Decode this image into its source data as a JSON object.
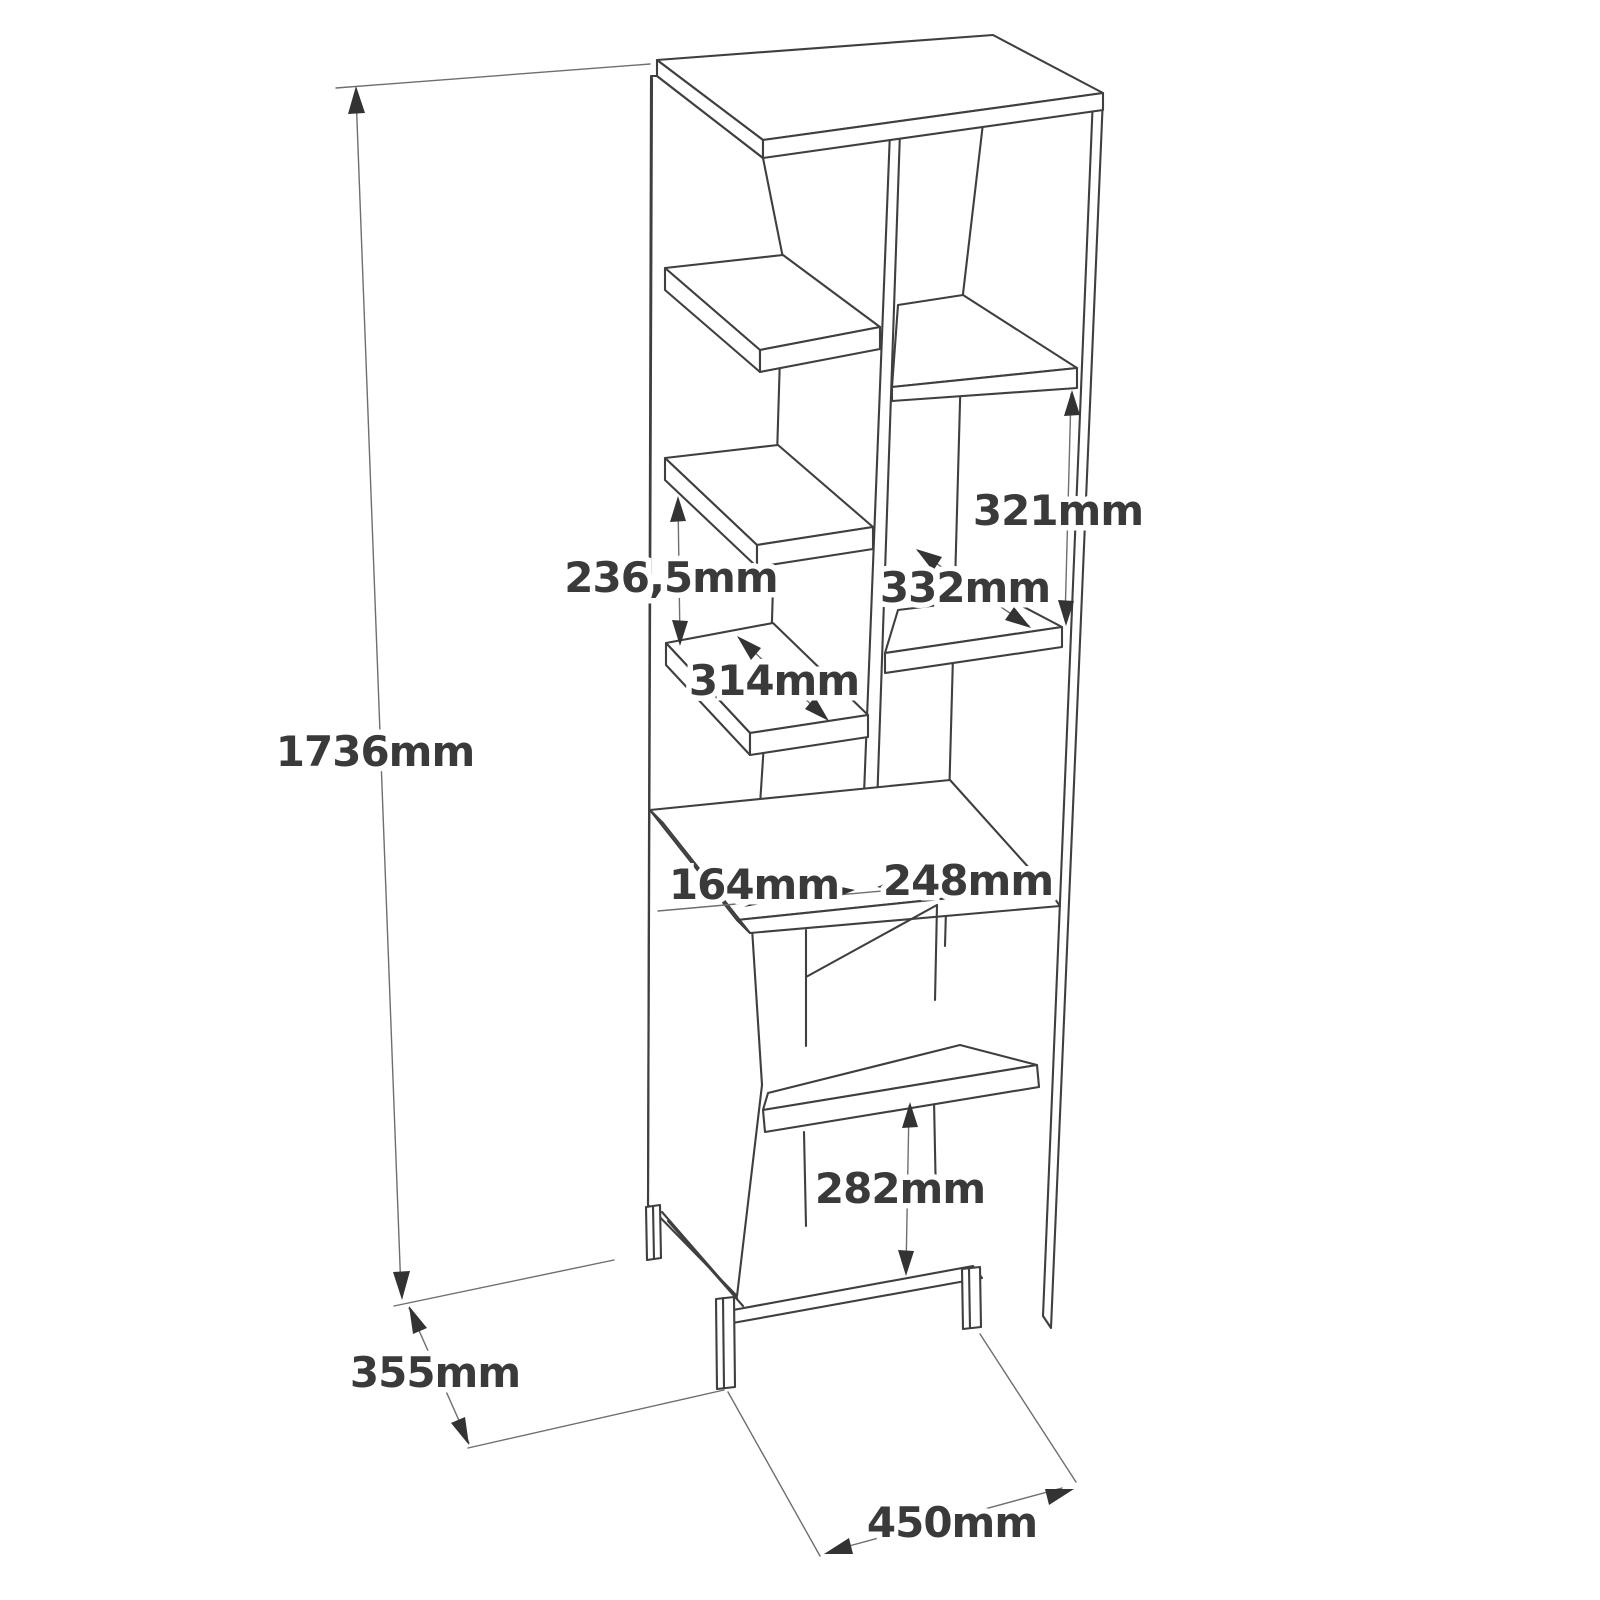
{
  "diagram": {
    "type": "furniture-dimension-drawing",
    "subject": "tall open bookshelf / cabinet unit, isometric line drawing",
    "unit_suffix": "mm",
    "dimensions": {
      "total_height": "1736mm",
      "depth": "355mm",
      "width": "450mm",
      "left_bay_shelf_gap": "236,5mm",
      "left_bay_shelf_depth": "314mm",
      "right_bay_shelf_gap": "321mm",
      "right_bay_shelf_depth": "332mm",
      "left_opening_width": "164mm",
      "right_opening_width": "248mm",
      "lower_cabinet_shelf_gap": "282mm"
    },
    "colors": {
      "background": "#ffffff",
      "furniture_line": "#3f3f3f",
      "dimension_line": "#6e6e6e",
      "arrow": "#333333",
      "label_text": "#3a3a3a"
    }
  }
}
